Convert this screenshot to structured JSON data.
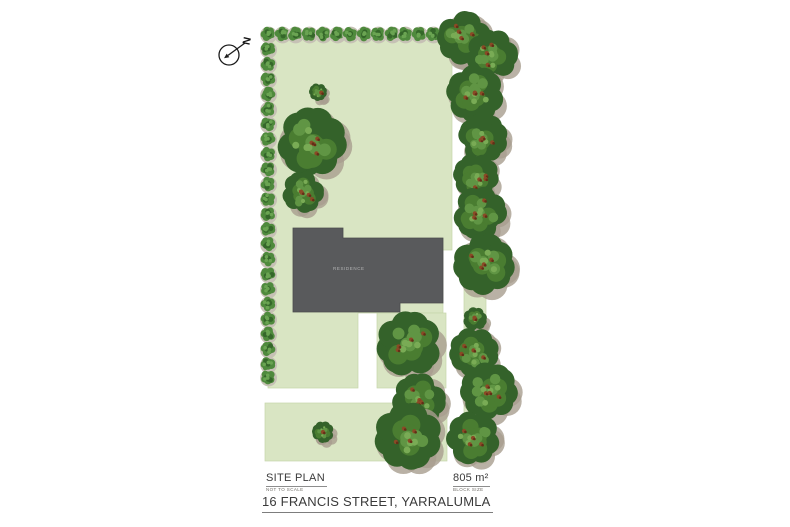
{
  "compass": {
    "label": "N"
  },
  "building": {
    "label": "RESIDENCE"
  },
  "title_block": {
    "site_plan": "SITE PLAN",
    "scale_note": "NOT TO SCALE",
    "area": "805 m²",
    "area_label": "BLOCK SIZE",
    "address": "16 FRANCIS STREET, YARRALUMLA"
  },
  "plan": {
    "colors": {
      "page_bg": "#ffffff",
      "lawn": "#d9e5c3",
      "lawn_edge": "#c7d6ab",
      "building_fill": "#595a5c",
      "building_edge": "#4b4c4e",
      "building_label": "#b3b4b5",
      "canopy_shadow": "#a79d8f",
      "canopy_dark": "#34622a",
      "canopy_mid": "#4a7d31",
      "canopy_light": "#609544",
      "canopy_lighter": "#79ab55",
      "berry": "#8a4a26",
      "berry_dark": "#632f17",
      "hedge_shadow": "#c6c1b5",
      "hedge_base": "#4f8a3d",
      "hedge_dark": "#35672a",
      "hedge_light": "#6aa452",
      "text_dark": "#3a3a3a",
      "text_muted": "#6f6c66",
      "underline": "#8d8d8d"
    },
    "lawn_shapes": [
      {
        "type": "polygon",
        "points": "268,35 452,35 452,250 443,250 443,313 358,313 358,388 268,388"
      },
      {
        "type": "rect",
        "x": 377,
        "y": 313,
        "w": 69,
        "h": 75
      },
      {
        "type": "rect",
        "x": 464,
        "y": 280,
        "w": 22,
        "h": 183
      },
      {
        "type": "rect",
        "x": 265,
        "y": 403,
        "w": 182,
        "h": 58
      }
    ],
    "building_outline": "293,228 343,228 343,238 443,238 443,303 400,303 400,312 293,312",
    "hedge_trees": [
      [
        268,
        34
      ],
      [
        282,
        34
      ],
      [
        295,
        34
      ],
      [
        309,
        34
      ],
      [
        323,
        34
      ],
      [
        337,
        34
      ],
      [
        350,
        34
      ],
      [
        364,
        34
      ],
      [
        378,
        34
      ],
      [
        392,
        34
      ],
      [
        405,
        34
      ],
      [
        419,
        34
      ],
      [
        433,
        34
      ],
      [
        447,
        34
      ],
      [
        268,
        49
      ],
      [
        268,
        64
      ],
      [
        268,
        79
      ],
      [
        268,
        94
      ],
      [
        268,
        109
      ],
      [
        268,
        124
      ],
      [
        268,
        139
      ],
      [
        268,
        154
      ],
      [
        268,
        169
      ],
      [
        268,
        184
      ],
      [
        268,
        199
      ],
      [
        268,
        214
      ],
      [
        268,
        229
      ],
      [
        268,
        244
      ],
      [
        268,
        259
      ],
      [
        268,
        274
      ],
      [
        268,
        289
      ],
      [
        268,
        304
      ],
      [
        268,
        319
      ],
      [
        268,
        334
      ],
      [
        268,
        349
      ],
      [
        268,
        364
      ],
      [
        268,
        377
      ]
    ],
    "big_trees": [
      [
        312,
        142,
        35
      ],
      [
        303,
        192,
        21
      ],
      [
        464,
        38,
        27
      ],
      [
        492,
        55,
        26
      ],
      [
        475,
        94,
        29
      ],
      [
        483,
        138,
        25
      ],
      [
        476,
        176,
        23
      ],
      [
        480,
        213,
        27
      ],
      [
        484,
        264,
        31
      ],
      [
        475,
        319,
        12
      ],
      [
        474,
        352,
        25
      ],
      [
        489,
        391,
        29
      ],
      [
        473,
        438,
        27
      ],
      [
        409,
        344,
        33
      ],
      [
        419,
        400,
        27
      ],
      [
        408,
        436,
        34
      ]
    ],
    "bushes": [
      [
        318,
        92,
        9
      ],
      [
        323,
        432,
        11
      ]
    ]
  }
}
